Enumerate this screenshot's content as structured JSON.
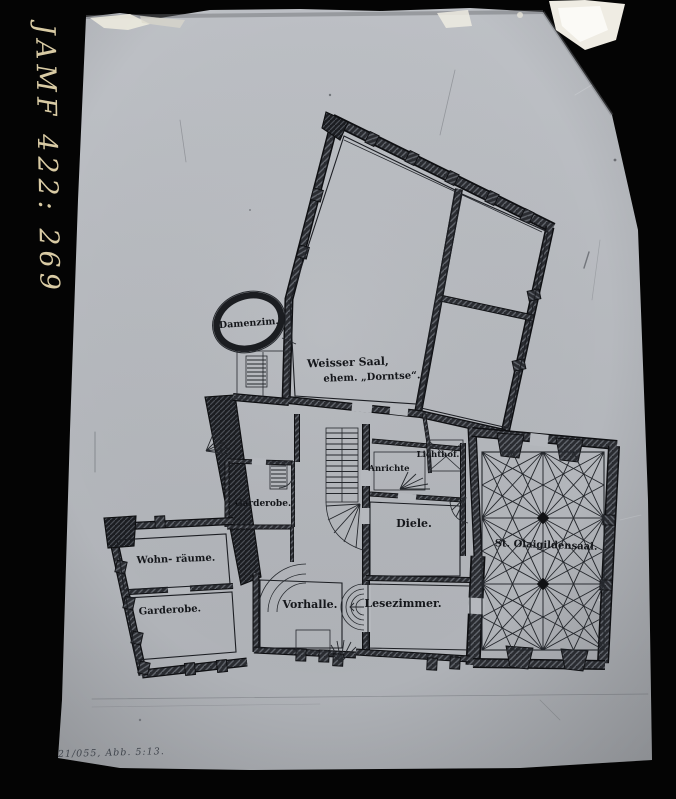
{
  "plate": {
    "handwritten_id": "JAMF 422: 269",
    "caption": "21/055, Abb. 5:13."
  },
  "plan": {
    "rooms": {
      "damenzimmer": "Damenzim.",
      "weisser_saal_line1": "Weisser Saal,",
      "weisser_saal_line2": "ehem. „Dorntse“.",
      "garderobe_mid": "Garderobe.",
      "wohnraeume": "Wohn- räume.",
      "garderobe_low": "Garderobe.",
      "vorhalle": "Vorhalle.",
      "lesezimmer": "Lesezimmer.",
      "diele": "Diele.",
      "anrichte": "Anrichte",
      "lichthof": "Lichthof.",
      "gildensaal": "St. Olaigildensaal."
    },
    "colors": {
      "paper": "#b6b9be",
      "ink": "#15171b",
      "plate_black": "#040404",
      "handwriting": "#d9cba4"
    }
  }
}
